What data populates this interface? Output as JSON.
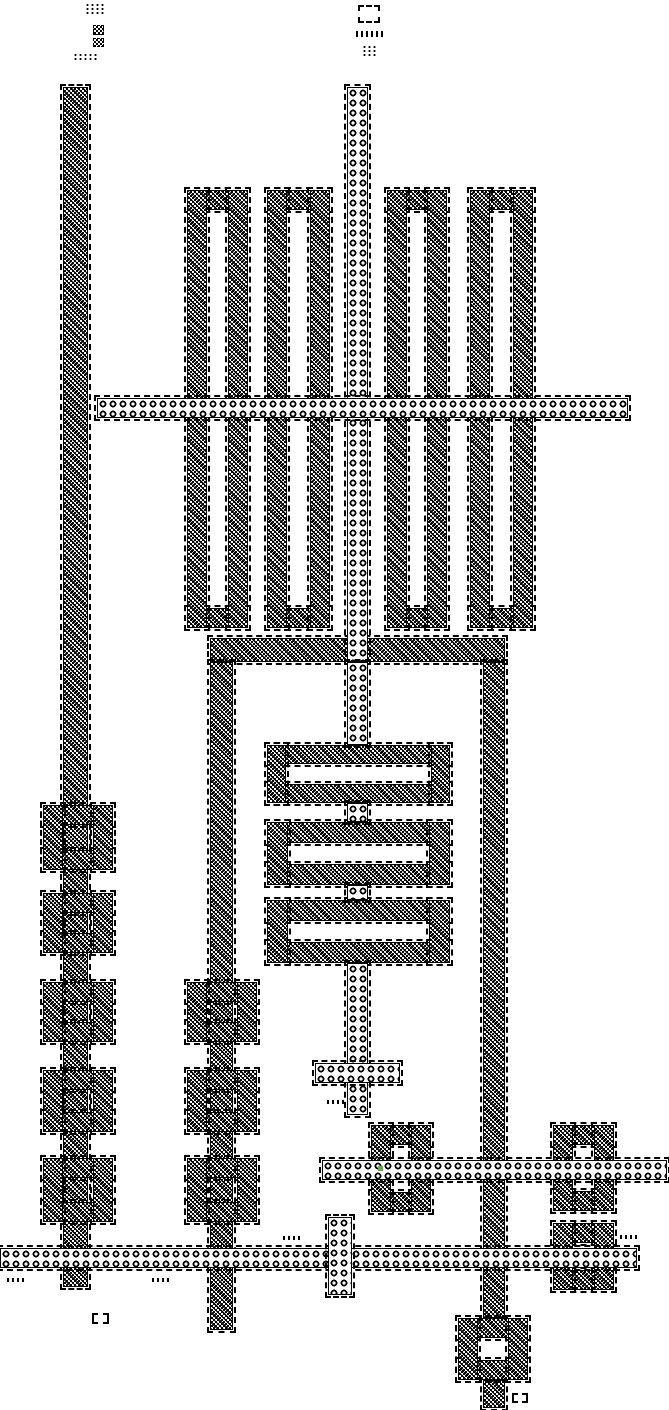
{
  "canvas": {
    "width": 669,
    "height": 1410,
    "background": "#ffffff",
    "ink": "#000000",
    "marker_color": "#66aa55"
  },
  "elements": [
    {
      "id": "left-bus-vertical",
      "kind": "maze",
      "x": 63,
      "y": 87,
      "w": 25,
      "h": 1200
    },
    {
      "id": "mid-block-top-bar",
      "kind": "maze",
      "x": 210,
      "y": 638,
      "w": 295,
      "h": 24
    },
    {
      "id": "mid-block-left-leg",
      "kind": "maze",
      "x": 210,
      "y": 662,
      "w": 23,
      "h": 668
    },
    {
      "id": "mid-block-right-leg",
      "kind": "maze",
      "x": 483,
      "y": 662,
      "w": 22,
      "h": 656
    },
    {
      "id": "right-leg-tail",
      "kind": "maze",
      "x": 483,
      "y": 1380,
      "w": 22,
      "h": 28
    },
    {
      "id": "tape-loop-1",
      "kind": "ring",
      "x": 187,
      "y": 190,
      "w": 61,
      "h": 438,
      "th": 20
    },
    {
      "id": "tape-loop-2",
      "kind": "ring",
      "x": 267,
      "y": 190,
      "w": 63,
      "h": 438,
      "th": 20
    },
    {
      "id": "tape-loop-3",
      "kind": "ring",
      "x": 387,
      "y": 190,
      "w": 60,
      "h": 438,
      "th": 20
    },
    {
      "id": "tape-loop-4",
      "kind": "ring",
      "x": 470,
      "y": 190,
      "w": 63,
      "h": 438,
      "th": 20
    },
    {
      "id": "inner-loop-1",
      "kind": "ring",
      "x": 267,
      "y": 745,
      "w": 183,
      "h": 58,
      "th": 19
    },
    {
      "id": "inner-loop-2",
      "kind": "ring",
      "x": 267,
      "y": 822,
      "w": 183,
      "h": 63,
      "th": 21
    },
    {
      "id": "inner-loop-3",
      "kind": "ring",
      "x": 267,
      "y": 900,
      "w": 183,
      "h": 63,
      "th": 21
    },
    {
      "id": "left-box-1",
      "kind": "ring",
      "x": 43,
      "y": 805,
      "w": 70,
      "h": 65,
      "th": 20
    },
    {
      "id": "left-box-2",
      "kind": "ring",
      "x": 43,
      "y": 893,
      "w": 70,
      "h": 60,
      "th": 20
    },
    {
      "id": "left-box-3",
      "kind": "ring",
      "x": 43,
      "y": 982,
      "w": 70,
      "h": 60,
      "th": 20
    },
    {
      "id": "left-box-4",
      "kind": "ring",
      "x": 43,
      "y": 1070,
      "w": 70,
      "h": 62,
      "th": 20
    },
    {
      "id": "left-box-5",
      "kind": "ring",
      "x": 43,
      "y": 1158,
      "w": 70,
      "h": 64,
      "th": 20
    },
    {
      "id": "col2-box-1",
      "kind": "ring",
      "x": 187,
      "y": 982,
      "w": 70,
      "h": 60,
      "th": 20
    },
    {
      "id": "col2-box-2",
      "kind": "ring",
      "x": 187,
      "y": 1070,
      "w": 70,
      "h": 62,
      "th": 20
    },
    {
      "id": "col2-box-3",
      "kind": "ring",
      "x": 187,
      "y": 1158,
      "w": 70,
      "h": 64,
      "th": 20
    },
    {
      "id": "right-box-a",
      "kind": "ring",
      "x": 371,
      "y": 1125,
      "w": 60,
      "h": 87,
      "th": 20
    },
    {
      "id": "right-box-b",
      "kind": "ring",
      "x": 553,
      "y": 1125,
      "w": 61,
      "h": 86,
      "th": 20
    },
    {
      "id": "right-box-c",
      "kind": "ring",
      "x": 553,
      "y": 1223,
      "w": 61,
      "h": 67,
      "th": 20
    },
    {
      "id": "bottom-box",
      "kind": "ring",
      "x": 458,
      "y": 1318,
      "w": 70,
      "h": 62,
      "th": 20
    },
    {
      "id": "center-stream-top",
      "kind": "beads",
      "x": 347,
      "y": 87,
      "w": 21,
      "h": 575
    },
    {
      "id": "center-stream-mid-1",
      "kind": "beads",
      "x": 347,
      "y": 662,
      "w": 21,
      "h": 83
    },
    {
      "id": "center-stream-mid-2",
      "kind": "beads",
      "x": 347,
      "y": 803,
      "w": 21,
      "h": 19
    },
    {
      "id": "center-stream-mid-3",
      "kind": "beads",
      "x": 347,
      "y": 885,
      "w": 21,
      "h": 15
    },
    {
      "id": "center-stream-low",
      "kind": "beads",
      "x": 347,
      "y": 963,
      "w": 21,
      "h": 152
    },
    {
      "id": "top-bus",
      "kind": "beads",
      "x": 97,
      "y": 398,
      "w": 531,
      "h": 20
    },
    {
      "id": "cross-bar",
      "kind": "beads",
      "x": 315,
      "y": 1063,
      "w": 85,
      "h": 20
    },
    {
      "id": "right-bus",
      "kind": "beads",
      "x": 322,
      "y": 1160,
      "w": 345,
      "h": 20
    },
    {
      "id": "bottom-bus",
      "kind": "beads",
      "x": 0,
      "y": 1248,
      "w": 637,
      "h": 20
    },
    {
      "id": "short-crossing",
      "kind": "beads",
      "x": 328,
      "y": 1217,
      "w": 24,
      "h": 78
    },
    {
      "id": "glyph-arrows-a",
      "kind": "arrows",
      "x": 85,
      "y": 3,
      "w": 20,
      "h": 13
    },
    {
      "id": "glyph-eater-a",
      "kind": "hash",
      "x": 93,
      "y": 25,
      "w": 11,
      "h": 10
    },
    {
      "id": "glyph-eater-b",
      "kind": "hash",
      "x": 93,
      "y": 38,
      "w": 11,
      "h": 9
    },
    {
      "id": "glyph-arrow-line",
      "kind": "arrows",
      "x": 73,
      "y": 53,
      "w": 26,
      "h": 9
    },
    {
      "id": "glyph-loop",
      "kind": "hollow",
      "x": 358,
      "y": 5,
      "w": 22,
      "h": 18
    },
    {
      "id": "glyph-dash-line",
      "kind": "dashes",
      "x": 356,
      "y": 31,
      "w": 27,
      "h": 6
    },
    {
      "id": "glyph-arrows-b",
      "kind": "arrows",
      "x": 362,
      "y": 45,
      "w": 16,
      "h": 13
    },
    {
      "id": "stream-a",
      "kind": "dashes",
      "x": 327,
      "y": 1100,
      "w": 17,
      "h": 4
    },
    {
      "id": "stream-b",
      "kind": "dashes",
      "x": 283,
      "y": 1236,
      "w": 18,
      "h": 4
    },
    {
      "id": "stream-c",
      "kind": "dashes",
      "x": 620,
      "y": 1235,
      "w": 18,
      "h": 4
    },
    {
      "id": "stream-d",
      "kind": "dashes",
      "x": 7,
      "y": 1278,
      "w": 18,
      "h": 4
    },
    {
      "id": "stream-e",
      "kind": "dashes",
      "x": 152,
      "y": 1278,
      "w": 18,
      "h": 4
    },
    {
      "id": "small-box-a",
      "kind": "hollow",
      "x": 92,
      "y": 1313,
      "w": 17,
      "h": 11
    },
    {
      "id": "small-box-b",
      "kind": "hollow",
      "x": 512,
      "y": 1393,
      "w": 16,
      "h": 10
    },
    {
      "id": "marker-cell",
      "kind": "marker",
      "x": 378,
      "y": 1166,
      "w": 5,
      "h": 5
    }
  ]
}
